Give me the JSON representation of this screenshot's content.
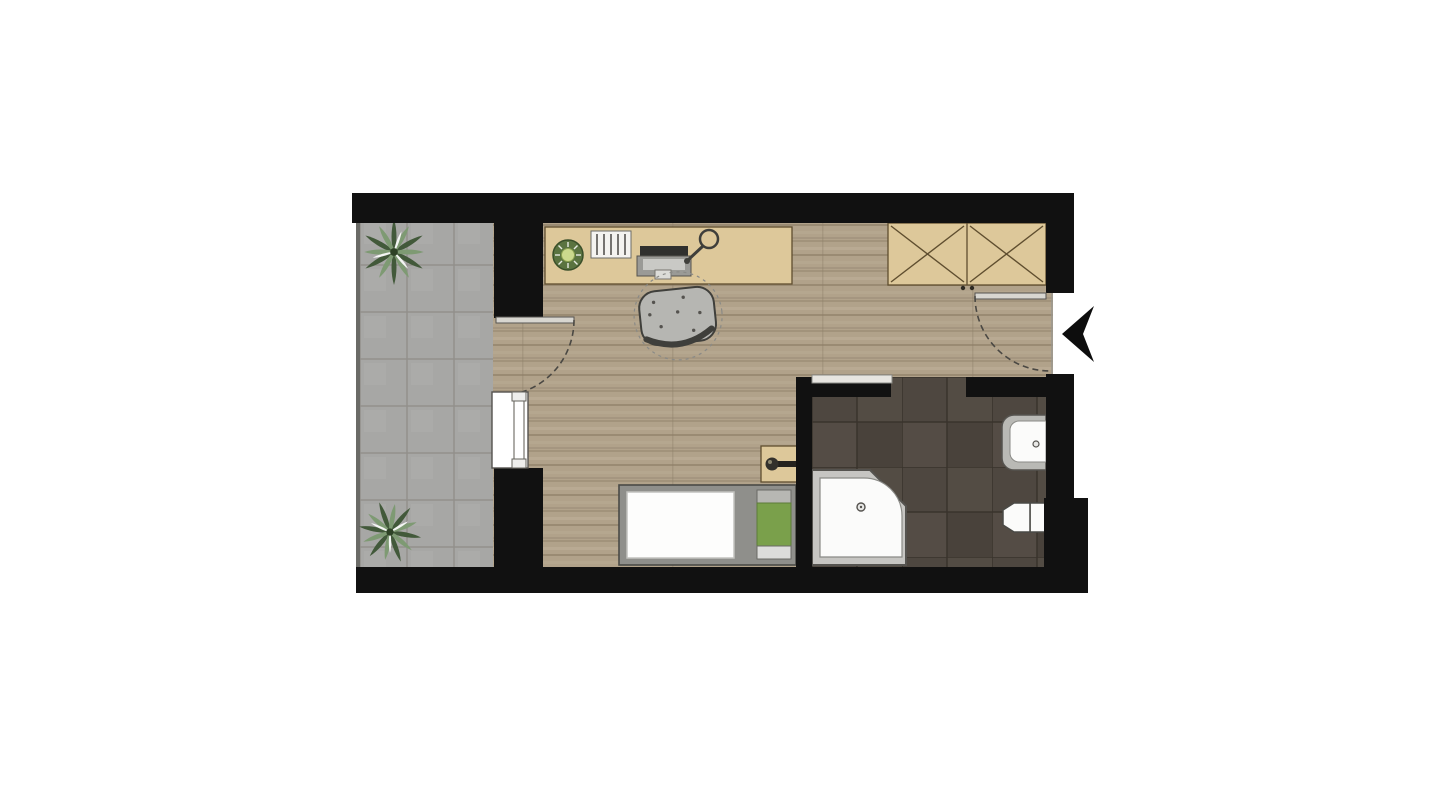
{
  "plan": {
    "kind": "studio-apartment-floor-plan",
    "rooms": [
      {
        "id": "balcony",
        "label": "balcony with tiled floor and two plants"
      },
      {
        "id": "main_room",
        "label": "main room with wood floor"
      },
      {
        "id": "bathroom",
        "label": "bathroom with dark tiled floor"
      }
    ],
    "furniture": [
      {
        "id": "desk",
        "label": "desk with plant, document tray, laptop and desk lamp"
      },
      {
        "id": "office_chair",
        "label": "office chair"
      },
      {
        "id": "wardrobe",
        "label": "two-section wardrobe marked with X"
      },
      {
        "id": "bed",
        "label": "single bed with white duvet and green pillow"
      },
      {
        "id": "nightstand",
        "label": "nightstand with reading lamp"
      }
    ],
    "fixtures": [
      {
        "id": "shower",
        "label": "corner shower with quarter-round glass door"
      },
      {
        "id": "washbasin",
        "label": "washbasin"
      },
      {
        "id": "toilet",
        "label": "toilet"
      },
      {
        "id": "window",
        "label": "window between room and balcony"
      },
      {
        "id": "balcony_door",
        "label": "balcony door swinging into room"
      },
      {
        "id": "entry_door",
        "label": "entrance door swinging into room"
      },
      {
        "id": "sliding_door",
        "label": "bathroom sliding door"
      }
    ],
    "indicators": [
      {
        "id": "entry_arrow",
        "label": "entrance direction arrow"
      }
    ],
    "plants": [
      {
        "id": "balcony_plant_top",
        "label": "balcony plant top"
      },
      {
        "id": "balcony_plant_bottom",
        "label": "balcony plant bottom"
      },
      {
        "id": "desk_plant",
        "label": "desk plant"
      }
    ]
  },
  "colors": {
    "background": "#ffffff",
    "wall": "#111111",
    "wood_floor": "#b1a28a",
    "balcony_tile": "#a7a7a5",
    "bathroom_tile": "#4e4740",
    "furniture_wood": "#ddc89a",
    "furniture_outline": "#5f4e2f",
    "bed_frame": "#8f8f8b",
    "pillow_green": "#7aa04b",
    "fixture_white": "#fbfbfa",
    "fixture_gray": "#c6c5c2",
    "line_dark": "#3f3f3b",
    "door_leaf": "#d8d6d0",
    "plant_dark": "#42593a",
    "plant_light": "#7e9a73"
  }
}
